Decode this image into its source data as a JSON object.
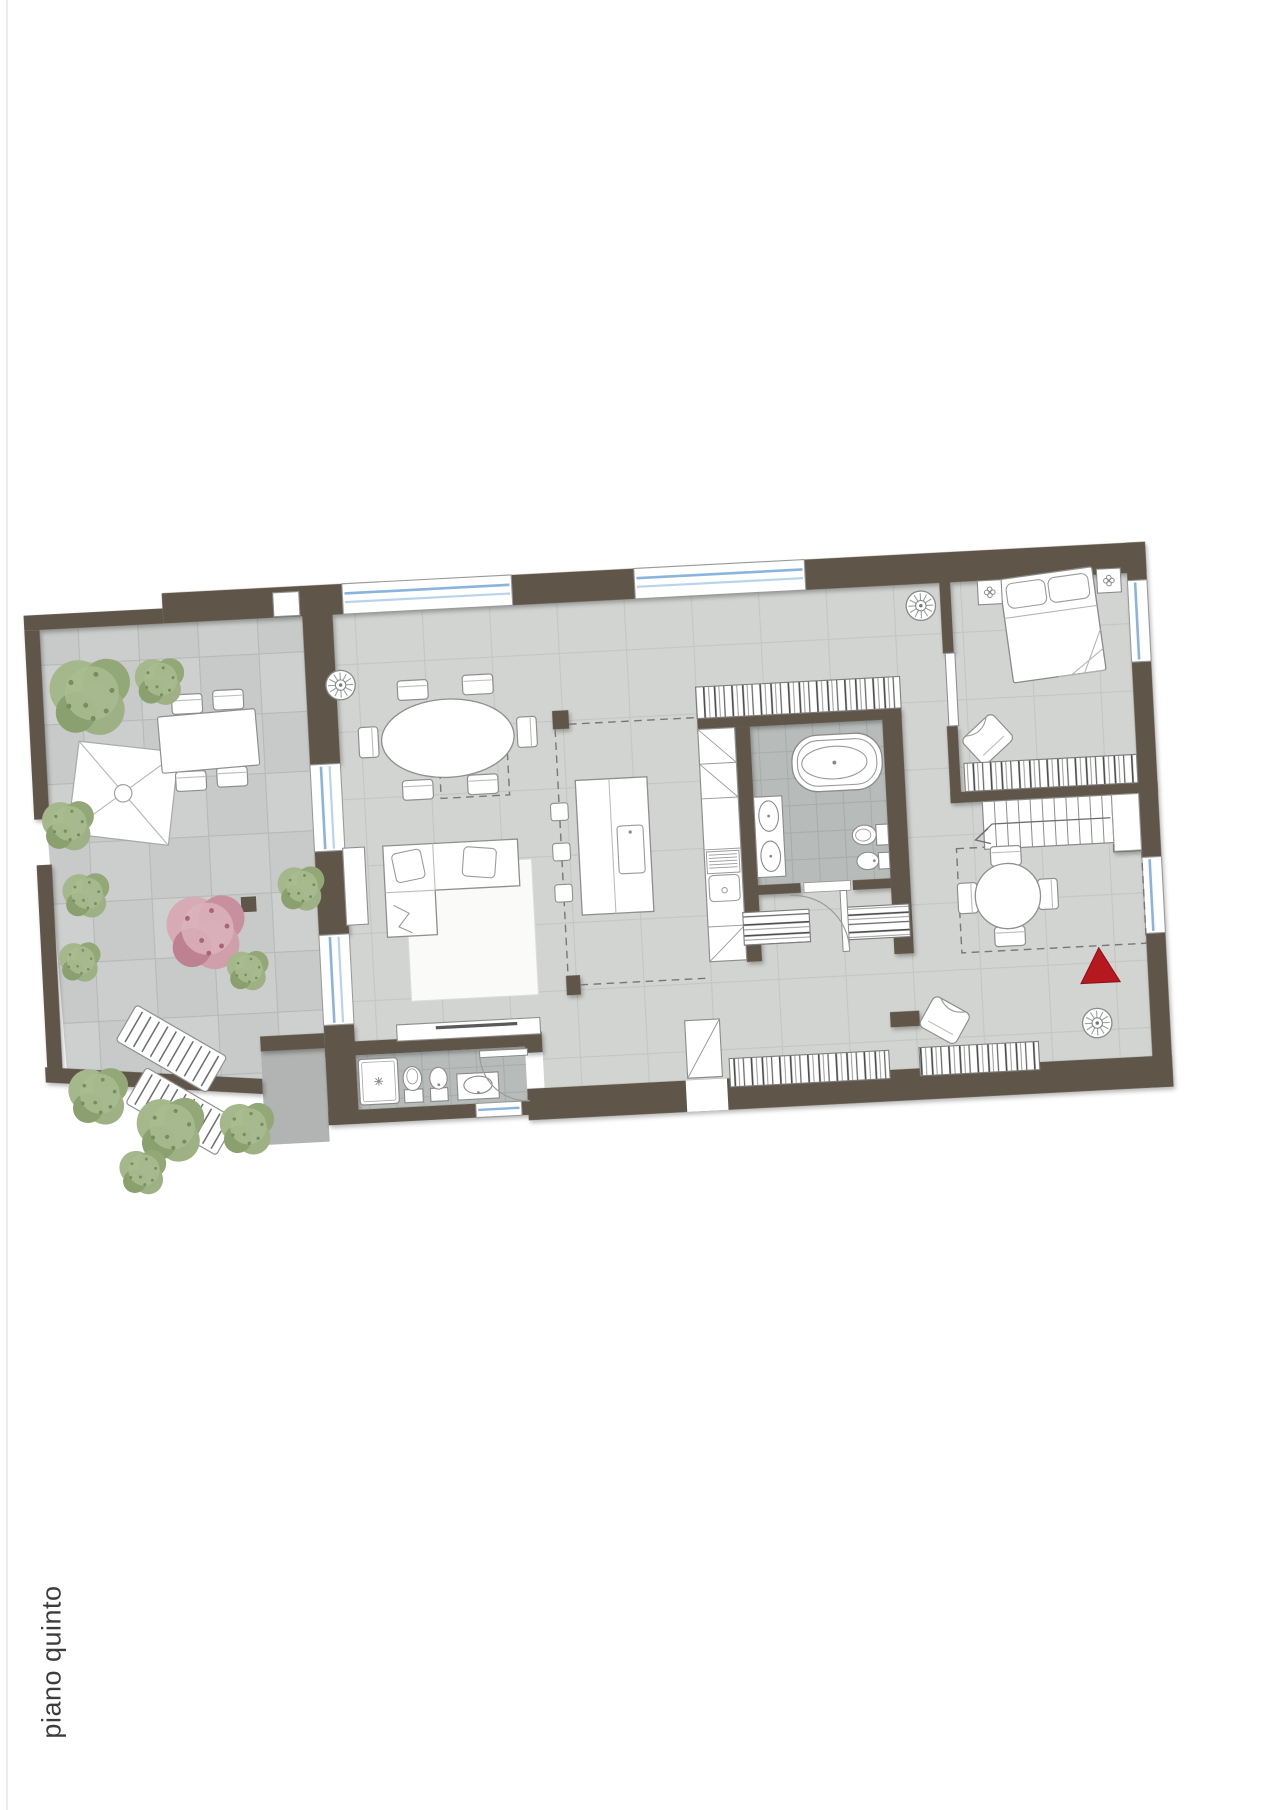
{
  "floor_label": "piano quinto",
  "plan": {
    "type": "apartment-floor-plan",
    "rotation_deg": -3,
    "colors": {
      "wall": "#5e564a",
      "interior_floor": "#d2d4d2",
      "floor_grout": "#c4c6c4",
      "bathroom_floor": "#b7bbb9",
      "terrace_paving": "#c7cac8",
      "lower_roof_slab": "#b1b4b2",
      "window_glass": "#8ab4dd",
      "furniture_fill": "#ffffff",
      "furniture_outline": "#8f8f8f",
      "entrance_marker": "#b5191f",
      "tree_green": "#9db184",
      "tree_pink": "#cf9fab",
      "label_text": "#3c3c3c"
    },
    "rooms": [
      "terrace-garden",
      "living-dining-room",
      "kitchen",
      "main-bathroom",
      "walk-in-closet",
      "bedroom",
      "second-bathroom",
      "hallway",
      "staircase"
    ],
    "furniture": [
      "outdoor-dining-table",
      "shade-sail",
      "sun-loungers",
      "trees",
      "oval-dining-table",
      "six-chairs",
      "corner-sofa",
      "rug",
      "tv-bench",
      "kitchen-island",
      "bar-stools",
      "tall-kitchen-units",
      "kitchen-sink",
      "bookshelf",
      "freestanding-bathtub",
      "double-washbasin",
      "toilet",
      "bidet",
      "wardrobes",
      "double-bed",
      "nightstands",
      "dresser",
      "armchairs",
      "stairs-with-landing",
      "round-table-four-chairs",
      "shower",
      "washbasin",
      "ceiling-fans",
      "entrance-triangle-marker"
    ]
  }
}
